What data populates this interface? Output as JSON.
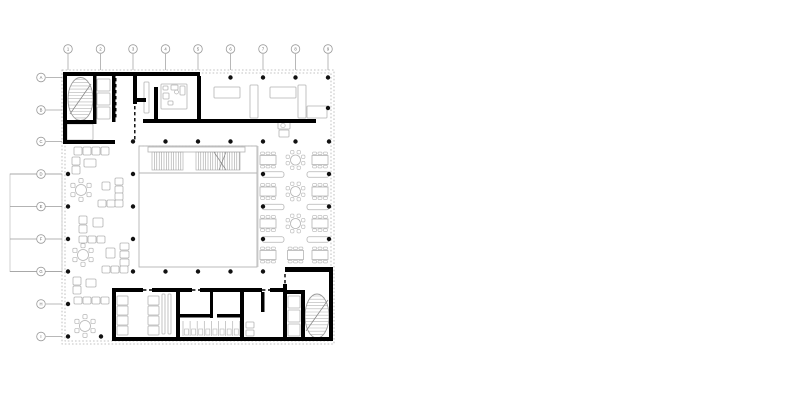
{
  "document": {
    "type": "architectural floor plan",
    "description": "ground floor plan with central atrium, tribune stair, dining hall, lounge and two stair cores"
  },
  "colors": {
    "background": "#ffffff",
    "wall": "#000000",
    "column": "#111111",
    "light": "#b4b4b4",
    "lighter": "#c6c6c6",
    "hatch": "#9a9a9a",
    "grid": "#9a9a9a",
    "label": "#6a6a6a",
    "dash": "#b0b0b0"
  },
  "grid": {
    "col_labels": [
      "1",
      "2",
      "3",
      "4",
      "5",
      "6",
      "7",
      "8",
      "9"
    ],
    "cols": [
      68,
      100.5,
      133,
      165.5,
      198,
      230.5,
      263,
      295.5,
      328
    ],
    "row_labels": [
      "A",
      "B",
      "C",
      "D",
      "E",
      "F",
      "G",
      "H",
      "I"
    ],
    "rows": [
      77.5,
      110,
      141.5,
      174,
      206.5,
      239,
      271.5,
      304,
      336.5
    ],
    "marker_r": 4.3,
    "top_cy": 49,
    "top_line_y2": 70,
    "left_cx": 41,
    "left_line_x2": 62,
    "long_stub_rows": [
      3,
      4,
      5,
      6
    ],
    "long_stub_x1": 10,
    "short_stub_left_x1": 46,
    "short_stub_top_y1": 54
  },
  "plan": {
    "facade_rects": [
      [
        62,
        70,
        272,
        274
      ],
      [
        65,
        73,
        266,
        268
      ]
    ],
    "terrace": [
      10,
      174,
      52,
      97.5
    ],
    "walls": [
      [
        63,
        72,
        137,
        4
      ],
      [
        63,
        72,
        4,
        72
      ],
      [
        63,
        140,
        52,
        4
      ],
      [
        93,
        76,
        3.5,
        48
      ],
      [
        112,
        76,
        3.5,
        46
      ],
      [
        67,
        120,
        26,
        4
      ],
      [
        133,
        72,
        4,
        32
      ],
      [
        133,
        98,
        13,
        4
      ],
      [
        154,
        87,
        4,
        34
      ],
      [
        197,
        76,
        4,
        47
      ],
      [
        143,
        119,
        173,
        4
      ],
      [
        285,
        267,
        48,
        5
      ],
      [
        283,
        284,
        4,
        57
      ],
      [
        287,
        290,
        15,
        4
      ],
      [
        301,
        290,
        4,
        51
      ],
      [
        329,
        272,
        4,
        69
      ],
      [
        112,
        337,
        221,
        4
      ],
      [
        112,
        288,
        4,
        49
      ],
      [
        116,
        288,
        27,
        4
      ],
      [
        152,
        288,
        40,
        4
      ],
      [
        200,
        288,
        62,
        4
      ],
      [
        270,
        288,
        13,
        4
      ],
      [
        176,
        292,
        4,
        45
      ],
      [
        210,
        292,
        3,
        26
      ],
      [
        240,
        292,
        4,
        45
      ],
      [
        180,
        314,
        30,
        3.5
      ],
      [
        217,
        314,
        23,
        3.5
      ],
      [
        261,
        292,
        3.5,
        20
      ]
    ],
    "door_dashes": [
      [
        115.8,
        78,
        115.8,
        120
      ],
      [
        134.8,
        106,
        134.8,
        140
      ],
      [
        285,
        274,
        285,
        286
      ],
      [
        284.8,
        296,
        284.8,
        336
      ],
      [
        143,
        290,
        152,
        290
      ],
      [
        192,
        290,
        200,
        290
      ],
      [
        262,
        290,
        270,
        290
      ]
    ],
    "columns": [
      [
        230.5,
        77.5
      ],
      [
        263,
        77.5
      ],
      [
        295.5,
        77.5
      ],
      [
        328,
        77.5
      ],
      [
        328,
        108
      ],
      [
        133,
        141.5
      ],
      [
        165.5,
        141.5
      ],
      [
        198,
        141.5
      ],
      [
        230.5,
        141.5
      ],
      [
        263,
        141.5
      ],
      [
        295.5,
        141.5
      ],
      [
        329,
        141.5
      ],
      [
        68,
        174
      ],
      [
        133,
        174
      ],
      [
        263,
        174
      ],
      [
        329,
        174
      ],
      [
        68,
        206.5
      ],
      [
        133,
        206.5
      ],
      [
        263,
        206.5
      ],
      [
        329,
        206.5
      ],
      [
        68,
        239
      ],
      [
        133,
        239
      ],
      [
        263,
        239
      ],
      [
        329,
        239
      ],
      [
        68,
        271.5
      ],
      [
        133,
        271.5
      ],
      [
        165.5,
        271.5
      ],
      [
        198,
        271.5
      ],
      [
        230.5,
        271.5
      ],
      [
        263,
        271.5
      ],
      [
        68,
        304
      ],
      [
        68,
        336.5
      ],
      [
        101,
        336.5
      ]
    ],
    "column_r": 2.2,
    "stairs": [
      {
        "cx": 80.5,
        "cy": 99,
        "rx": 12.5,
        "ry": 21.5,
        "step": 3.2,
        "diag": [
          70,
          114,
          91,
          84
        ]
      },
      {
        "cx": 317,
        "cy": 316,
        "rx": 12,
        "ry": 22,
        "step": 3.2,
        "diag": [
          306,
          331,
          328,
          300
        ]
      }
    ],
    "light_rects": [
      [
        97,
        79,
        13,
        12
      ],
      [
        97,
        93,
        13,
        12
      ],
      [
        97,
        107,
        13,
        12
      ],
      [
        67,
        124,
        26,
        16
      ],
      [
        144,
        82,
        5,
        31
      ],
      [
        161,
        84,
        26,
        25
      ],
      [
        163,
        86,
        5,
        4
      ],
      [
        171,
        85,
        7,
        5
      ],
      [
        180,
        86,
        5,
        9
      ],
      [
        163,
        93,
        6,
        6
      ],
      [
        168,
        101,
        5,
        4
      ],
      [
        214,
        87,
        26,
        11
      ],
      [
        250,
        85,
        8,
        33
      ],
      [
        270,
        87,
        26,
        11
      ],
      [
        298,
        85,
        8,
        33
      ],
      [
        307,
        106,
        20,
        12
      ],
      [
        278,
        122,
        12,
        7
      ],
      [
        279,
        130,
        10,
        7
      ],
      [
        288,
        296,
        12,
        12
      ],
      [
        288,
        310,
        12,
        12
      ],
      [
        288,
        324,
        12,
        12
      ],
      [
        117,
        296,
        11,
        9
      ],
      [
        117,
        306,
        11,
        9
      ],
      [
        117,
        316,
        11,
        9
      ],
      [
        117,
        326,
        11,
        9
      ],
      [
        148,
        296,
        11,
        9
      ],
      [
        148,
        306,
        11,
        9
      ],
      [
        148,
        316,
        11,
        9
      ],
      [
        148,
        326,
        11,
        9
      ],
      [
        162,
        294,
        3,
        40
      ],
      [
        168,
        294,
        3,
        40
      ],
      [
        246,
        322,
        8,
        6
      ],
      [
        246,
        330,
        8,
        6
      ]
    ],
    "light_circles": [
      [
        283,
        125.5,
        2.2
      ],
      [
        176.5,
        92,
        2
      ]
    ],
    "atrium": {
      "rect": [
        139,
        146,
        118,
        121
      ],
      "mid_line": [
        139,
        173,
        257,
        173
      ],
      "zone_line": [
        258,
        146,
        258,
        267
      ],
      "tribune_bar": [
        148,
        147,
        97,
        5
      ],
      "hatch_y1": 152,
      "hatch_y2": 170,
      "hatch_step": 2.4,
      "hatch_segments": [
        [
          152,
          183
        ],
        [
          196,
          240
        ]
      ],
      "diagonals": [
        [
          214,
          152,
          226,
          170
        ],
        [
          226,
          152,
          219,
          170
        ]
      ]
    },
    "wc": {
      "x0": 183,
      "step": 7.1,
      "count": 8,
      "y1": 321,
      "y2": 336,
      "fix_y": 329,
      "fix_w": 4,
      "fix_h": 6
    },
    "dining": {
      "rows": [
        {
          "y": 160,
          "tables": [
            {
              "t": "rect",
              "x": 268
            },
            {
              "t": "round",
              "x": 295.5
            },
            {
              "t": "rect",
              "x": 320
            }
          ]
        },
        {
          "y": 191.5,
          "tables": [
            {
              "t": "rect",
              "x": 268
            },
            {
              "t": "round",
              "x": 295.5
            },
            {
              "t": "rect",
              "x": 320
            }
          ]
        },
        {
          "y": 223.5,
          "tables": [
            {
              "t": "rect",
              "x": 268
            },
            {
              "t": "round",
              "x": 295.5
            },
            {
              "t": "rect",
              "x": 320
            }
          ]
        },
        {
          "y": 255,
          "tables": [
            {
              "t": "rect",
              "x": 268
            },
            {
              "t": "rect",
              "x": 295.5
            },
            {
              "t": "rect",
              "x": 320
            }
          ]
        }
      ],
      "rect_w": 16,
      "rect_h": 9,
      "round_r": 5,
      "benches": [
        [
          273,
          174.5
        ],
        [
          318,
          174.5
        ],
        [
          273,
          207
        ],
        [
          318,
          207
        ],
        [
          273,
          239.5
        ],
        [
          318,
          239.5
        ]
      ],
      "bench_w": 22,
      "bench_h": 5.5
    },
    "lounge": {
      "round_tables": [
        [
          81,
          190
        ],
        [
          83,
          255
        ],
        [
          85,
          326
        ]
      ],
      "round_r": 5.5,
      "sofas": [
        [
          74,
          147,
          8,
          8
        ],
        [
          83,
          147,
          8,
          8
        ],
        [
          92,
          147,
          8,
          8
        ],
        [
          101,
          147,
          8,
          8
        ],
        [
          72,
          157,
          8,
          8
        ],
        [
          72,
          166,
          8,
          8
        ],
        [
          84,
          159,
          12,
          8
        ],
        [
          102,
          182,
          8,
          8
        ],
        [
          115,
          178,
          8,
          7
        ],
        [
          115,
          186,
          8,
          7
        ],
        [
          115,
          193,
          8,
          7
        ],
        [
          98,
          200,
          8,
          7
        ],
        [
          107,
          200,
          8,
          7
        ],
        [
          115,
          200,
          8,
          7
        ],
        [
          79,
          216,
          8,
          8
        ],
        [
          79,
          225,
          8,
          8
        ],
        [
          93,
          218,
          10,
          9
        ],
        [
          79,
          236,
          8,
          7
        ],
        [
          88,
          236,
          8,
          7
        ],
        [
          97,
          236,
          8,
          7
        ],
        [
          106,
          248,
          9,
          10
        ],
        [
          120,
          243,
          9,
          7
        ],
        [
          120,
          251,
          9,
          7
        ],
        [
          120,
          259,
          9,
          7
        ],
        [
          102,
          266,
          8,
          7
        ],
        [
          111,
          266,
          8,
          7
        ],
        [
          120,
          266,
          8,
          7
        ],
        [
          73,
          277,
          8,
          8
        ],
        [
          73,
          286,
          8,
          8
        ],
        [
          86,
          279,
          10,
          8
        ],
        [
          74,
          297,
          8,
          7
        ],
        [
          83,
          297,
          8,
          7
        ],
        [
          92,
          297,
          8,
          7
        ],
        [
          101,
          297,
          8,
          7
        ]
      ]
    }
  }
}
